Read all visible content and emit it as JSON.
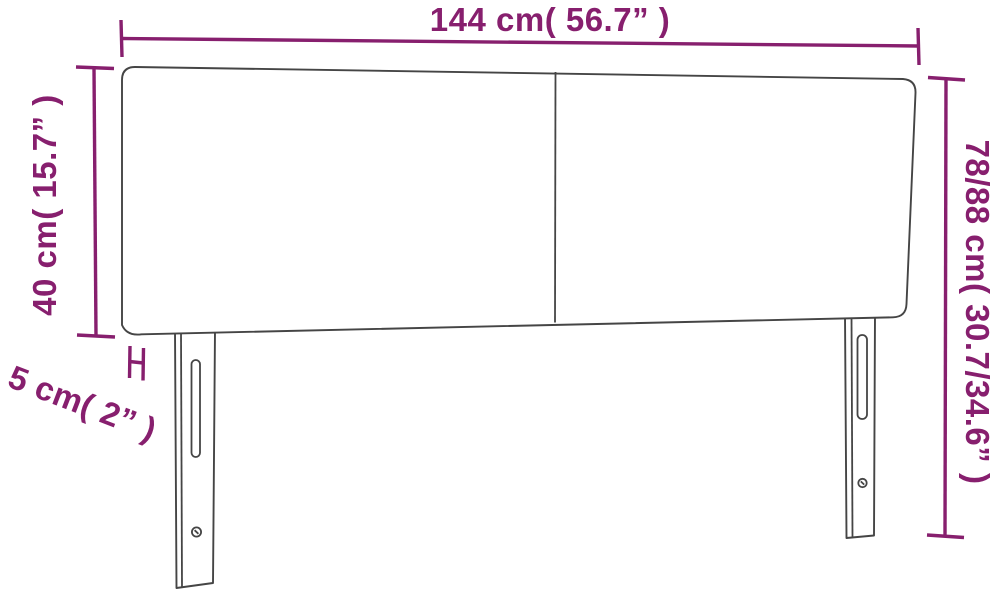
{
  "diagram": {
    "product": "headboard-dimension-diagram",
    "dimensions": {
      "width": {
        "label": "144 cm( 56.7” )"
      },
      "panel_height": {
        "label": "40 cm( 15.7” )"
      },
      "total_height": {
        "label": "78/88 cm( 30.7/34.6” )"
      },
      "depth": {
        "label": "5 cm( 2” )"
      }
    }
  },
  "colors": {
    "accent": "#871F6E",
    "outline": "#454545",
    "background": "#FFFFFF"
  }
}
